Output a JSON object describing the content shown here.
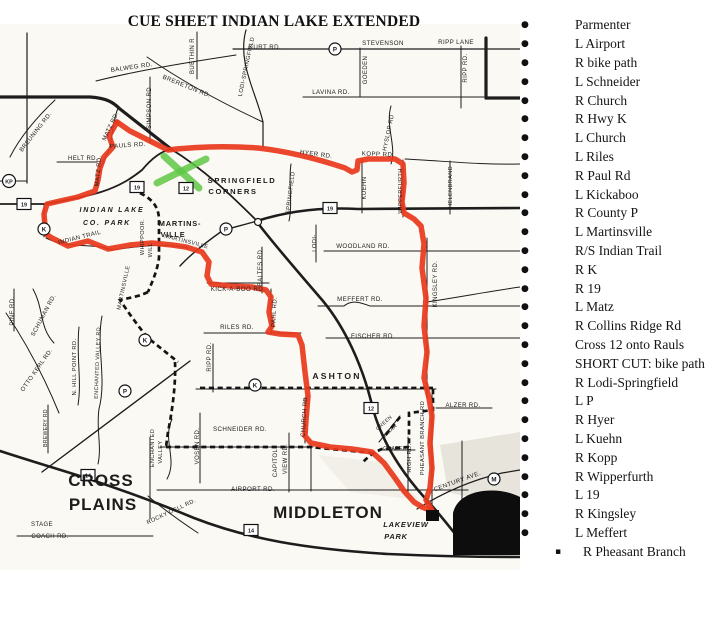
{
  "title": "CUE SHEET INDIAN LAKE EXTENDED",
  "cues": {
    "items": [
      {
        "bullet": "round",
        "text": "Parmenter"
      },
      {
        "bullet": "round",
        "text": "L Airport"
      },
      {
        "bullet": "round",
        "text": "R bike path"
      },
      {
        "bullet": "round",
        "text": "L Schneider"
      },
      {
        "bullet": "round",
        "text": "R Church"
      },
      {
        "bullet": "round",
        "text": "R Hwy K"
      },
      {
        "bullet": "round",
        "text": "L Church"
      },
      {
        "bullet": "round",
        "text": "L Riles"
      },
      {
        "bullet": "round",
        "text": "R Paul Rd"
      },
      {
        "bullet": "round",
        "text": "L Kickaboo"
      },
      {
        "bullet": "round",
        "text": "R County P"
      },
      {
        "bullet": "round",
        "text": "L Martinsville"
      },
      {
        "bullet": "round",
        "text": "R/S Indian Trail"
      },
      {
        "bullet": "round",
        "text": "R K"
      },
      {
        "bullet": "round",
        "text": "R 19"
      },
      {
        "bullet": "round",
        "text": "L Matz"
      },
      {
        "bullet": "round",
        "text": "R Collins Ridge Rd"
      },
      {
        "bullet": "round",
        "text": "Cross 12 onto Rauls"
      },
      {
        "bullet": "round",
        "text": "SHORT CUT: bike path"
      },
      {
        "bullet": "round",
        "text": "R Lodi-Springfield"
      },
      {
        "bullet": "round",
        "text": "L P"
      },
      {
        "bullet": "round",
        "text": "R Hyer"
      },
      {
        "bullet": "round",
        "text": "L Kuehn"
      },
      {
        "bullet": "round",
        "text": "R Kopp"
      },
      {
        "bullet": "round",
        "text": "R Wipperfurth"
      },
      {
        "bullet": "round",
        "text": "L 19"
      },
      {
        "bullet": "round",
        "text": "R Kingsley"
      },
      {
        "bullet": "round",
        "text": "L Meffert"
      },
      {
        "bullet": "square",
        "text": "R Pheasant Branch"
      }
    ]
  },
  "map": {
    "colors": {
      "route": "#e8391d",
      "shortcut": "#141414",
      "highlight": "#5ec844",
      "lake": "#0d0d0d",
      "shade": "#d8d4ca",
      "paper": "#fbf9f3"
    },
    "labels": [
      {
        "t": "KURT RD.",
        "x": 265,
        "y": 49,
        "r": 0,
        "s": 6.2
      },
      {
        "t": "STEVENSON",
        "x": 383,
        "y": 45,
        "r": 0,
        "s": 6.2
      },
      {
        "t": "RIPP LANE",
        "x": 456,
        "y": 44,
        "r": 0,
        "s": 6.2
      },
      {
        "t": "BALWEG RD.",
        "x": 132,
        "y": 69,
        "r": -8,
        "s": 6.2
      },
      {
        "t": "BUETHIN R",
        "x": 194,
        "y": 56,
        "r": -90,
        "s": 6
      },
      {
        "t": "BRERETON RD.",
        "x": 186,
        "y": 88,
        "r": 22,
        "s": 6.2
      },
      {
        "t": "LODI-SPRINGFIELD",
        "x": 248,
        "y": 67,
        "r": -78,
        "s": 5.8
      },
      {
        "t": "GOEDEN",
        "x": 367,
        "y": 70,
        "r": -90,
        "s": 6
      },
      {
        "t": "LAVINA RD.",
        "x": 331,
        "y": 94,
        "r": 0,
        "s": 6.2
      },
      {
        "t": "RIPP RD.",
        "x": 467,
        "y": 68,
        "r": -90,
        "s": 6
      },
      {
        "t": "HYSLOP RD",
        "x": 390,
        "y": 133,
        "r": -78,
        "s": 5.8
      },
      {
        "t": "SIMPSON RD",
        "x": 151,
        "y": 108,
        "r": -90,
        "s": 6
      },
      {
        "t": "MATZ RD.",
        "x": 112,
        "y": 127,
        "r": -65,
        "s": 6
      },
      {
        "t": "MATZ RD.",
        "x": 100,
        "y": 171,
        "r": -85,
        "s": 6
      },
      {
        "t": "HELT RD.",
        "x": 83,
        "y": 160,
        "r": 0,
        "s": 6
      },
      {
        "t": "BREUNING RD.",
        "x": 37,
        "y": 133,
        "r": -52,
        "s": 6
      },
      {
        "t": "PAULS RD.",
        "x": 128,
        "y": 147,
        "r": -4,
        "s": 6.2
      },
      {
        "t": "HYER RD.",
        "x": 316,
        "y": 156,
        "r": 8,
        "s": 6.2
      },
      {
        "t": "KOPP RD.",
        "x": 378,
        "y": 156,
        "r": 2,
        "s": 6.2
      },
      {
        "t": "KUEHN",
        "x": 366,
        "y": 188,
        "r": -90,
        "s": 6
      },
      {
        "t": "WIPPERFURTH",
        "x": 402,
        "y": 191,
        "r": -90,
        "s": 5.6
      },
      {
        "t": "HELENBRAND",
        "x": 452,
        "y": 187,
        "r": -90,
        "s": 5.6
      },
      {
        "t": "SPRINGFIELD",
        "x": 292,
        "y": 193,
        "r": -83,
        "s": 5.8
      },
      {
        "t": "LODI-",
        "x": 316,
        "y": 243,
        "r": -90,
        "s": 5.8
      },
      {
        "t": "WOODLAND RD.",
        "x": 363,
        "y": 248,
        "r": 0,
        "s": 6.2
      },
      {
        "t": "MEFFERT RD.",
        "x": 360,
        "y": 301,
        "r": 0,
        "s": 6.2
      },
      {
        "t": "FISCHER RD.",
        "x": 373,
        "y": 338,
        "r": 0,
        "s": 6.2
      },
      {
        "t": "KINGSLEY RD.",
        "x": 437,
        "y": 284,
        "r": -90,
        "s": 6
      },
      {
        "t": "MARTINSVILLE",
        "x": 186,
        "y": 243,
        "r": 14,
        "s": 5.6
      },
      {
        "t": "WHIPPOOR.",
        "x": 144,
        "y": 237,
        "r": -90,
        "s": 5.6
      },
      {
        "t": "WILL",
        "x": 152,
        "y": 250,
        "r": -90,
        "s": 5.6
      },
      {
        "t": "MARTINSVILLE",
        "x": 125,
        "y": 288,
        "r": -78,
        "s": 5.6
      },
      {
        "t": "INDIAN TRAIL",
        "x": 80,
        "y": 239,
        "r": -14,
        "s": 6
      },
      {
        "t": "KICK-A-BOO RD.",
        "x": 238,
        "y": 291,
        "r": 0,
        "s": 6.2
      },
      {
        "t": "PAHL RD.",
        "x": 276,
        "y": 312,
        "r": -87,
        "s": 6
      },
      {
        "t": "BALTES RD.",
        "x": 262,
        "y": 267,
        "r": -90,
        "s": 6
      },
      {
        "t": "RILES RD.",
        "x": 237,
        "y": 329,
        "r": 0,
        "s": 6.2
      },
      {
        "t": "RIPP RD.",
        "x": 211,
        "y": 357,
        "r": -90,
        "s": 6
      },
      {
        "t": "SCHNEIDER RD.",
        "x": 240,
        "y": 431,
        "r": 0,
        "s": 6.2
      },
      {
        "t": "VOSEN RD.",
        "x": 199,
        "y": 446,
        "r": -90,
        "s": 6
      },
      {
        "t": "CAPITOL",
        "x": 277,
        "y": 463,
        "r": -90,
        "s": 6
      },
      {
        "t": "VIEW RD.",
        "x": 287,
        "y": 459,
        "r": -90,
        "s": 6
      },
      {
        "t": "CHURCH RD.",
        "x": 306,
        "y": 416,
        "r": -86,
        "s": 6
      },
      {
        "t": "ENCHANTED VALLEY RD.",
        "x": 99,
        "y": 362,
        "r": -88,
        "s": 5.4
      },
      {
        "t": "ENCHANTED",
        "x": 154,
        "y": 448,
        "r": -90,
        "s": 5.6
      },
      {
        "t": "VALLEY",
        "x": 162,
        "y": 452,
        "r": -90,
        "s": 5.6
      },
      {
        "t": "N. HILL POINT RD.",
        "x": 76,
        "y": 367,
        "r": -90,
        "s": 5.8
      },
      {
        "t": "OTTO KERL RD.",
        "x": 38,
        "y": 371,
        "r": -55,
        "s": 6
      },
      {
        "t": "SCHUMAN RD.",
        "x": 45,
        "y": 316,
        "r": -62,
        "s": 6
      },
      {
        "t": "PINE RD.",
        "x": 14,
        "y": 311,
        "r": -90,
        "s": 6
      },
      {
        "t": "BREWERY RD",
        "x": 47,
        "y": 428,
        "r": -90,
        "s": 5
      },
      {
        "t": "ROCKY DELL RD.",
        "x": 172,
        "y": 513,
        "r": -25,
        "s": 5.8
      },
      {
        "t": "AIRPORT RD.",
        "x": 253,
        "y": 491,
        "r": 0,
        "s": 6.2
      },
      {
        "t": "STAGE",
        "x": 42,
        "y": 526,
        "r": 0,
        "s": 6
      },
      {
        "t": "COACH RD.",
        "x": 50,
        "y": 538,
        "r": 0,
        "s": 6
      },
      {
        "t": "CENTURY AVE.",
        "x": 458,
        "y": 483,
        "r": -20,
        "s": 6.2
      },
      {
        "t": "ALZER RD.",
        "x": 463,
        "y": 407,
        "r": 0,
        "s": 6
      },
      {
        "t": "GREEN",
        "x": 385,
        "y": 424,
        "r": -42,
        "s": 5
      },
      {
        "t": "BRIAR",
        "x": 391,
        "y": 432,
        "r": -42,
        "s": 5
      },
      {
        "t": "GRABER",
        "x": 395,
        "y": 450,
        "r": 0,
        "s": 5
      },
      {
        "t": "HIGH RD.",
        "x": 411,
        "y": 458,
        "r": -90,
        "s": 5.8
      },
      {
        "t": "PHEASANT BRANCH RD",
        "x": 424,
        "y": 438,
        "r": -90,
        "s": 5.8
      },
      {
        "t": "SPRINGFIELD",
        "x": 242,
        "y": 183,
        "r": 0,
        "s": 7.6,
        "b": 1,
        "ls": 1.6,
        "k": "town-label"
      },
      {
        "t": "CORNERS",
        "x": 233,
        "y": 194,
        "r": 0,
        "s": 7.6,
        "b": 1,
        "ls": 1.6,
        "k": "town-label"
      },
      {
        "t": "MARTINS-",
        "x": 180,
        "y": 226,
        "r": 0,
        "s": 7.4,
        "b": 1,
        "ls": 0.8,
        "k": "town-label"
      },
      {
        "t": "VILLE",
        "x": 173,
        "y": 237,
        "r": 0,
        "s": 7.4,
        "b": 1,
        "ls": 0.8,
        "k": "town-label"
      },
      {
        "t": "INDIAN LAKE",
        "x": 112,
        "y": 212,
        "r": 0,
        "s": 7,
        "b": 1,
        "i": 1,
        "ls": 1.8,
        "k": "town-label"
      },
      {
        "t": "CO. PARK",
        "x": 107,
        "y": 225,
        "r": 0,
        "s": 7,
        "b": 1,
        "i": 1,
        "ls": 1.8,
        "k": "town-label"
      },
      {
        "t": "ASHTON",
        "x": 337,
        "y": 379,
        "r": 0,
        "s": 8.6,
        "b": 1,
        "ls": 2.2,
        "k": "town-label"
      },
      {
        "t": "CROSS",
        "x": 101,
        "y": 486,
        "r": 0,
        "s": 17,
        "b": 1,
        "ls": 1,
        "k": "town-label"
      },
      {
        "t": "PLAINS",
        "x": 103,
        "y": 510,
        "r": 0,
        "s": 17,
        "b": 1,
        "ls": 1,
        "k": "town-label"
      },
      {
        "t": "MIDDLETON",
        "x": 328,
        "y": 518,
        "r": 0,
        "s": 17,
        "b": 1,
        "ls": 1,
        "k": "town-label"
      },
      {
        "t": "LAKEVIEW",
        "x": 406,
        "y": 527,
        "r": 0,
        "s": 7.4,
        "b": 1,
        "i": 1,
        "ls": 0.8,
        "k": "town-label"
      },
      {
        "t": "PARK",
        "x": 396,
        "y": 539,
        "r": 0,
        "s": 7.4,
        "b": 1,
        "i": 1,
        "ls": 0.8,
        "k": "town-label"
      }
    ],
    "shields": [
      {
        "shape": "circle",
        "label": "KP",
        "x": 9,
        "y": 181
      },
      {
        "shape": "circle",
        "label": "K",
        "x": 44,
        "y": 229
      },
      {
        "shape": "circle",
        "label": "K",
        "x": 145,
        "y": 340
      },
      {
        "shape": "circle",
        "label": "K",
        "x": 255,
        "y": 385
      },
      {
        "shape": "circle",
        "label": "P",
        "x": 335,
        "y": 49
      },
      {
        "shape": "circle",
        "label": "P",
        "x": 226,
        "y": 229
      },
      {
        "shape": "circle",
        "label": "P",
        "x": 125,
        "y": 391
      },
      {
        "shape": "circle",
        "label": "M",
        "x": 494,
        "y": 479
      },
      {
        "shape": "box",
        "label": "19",
        "x": 24,
        "y": 204
      },
      {
        "shape": "box",
        "label": "19",
        "x": 137,
        "y": 187
      },
      {
        "shape": "box",
        "label": "19",
        "x": 330,
        "y": 208
      },
      {
        "shape": "box",
        "label": "12",
        "x": 186,
        "y": 188
      },
      {
        "shape": "box",
        "label": "12",
        "x": 371,
        "y": 408
      },
      {
        "shape": "box",
        "label": "14",
        "x": 88,
        "y": 475
      },
      {
        "shape": "box",
        "label": "14",
        "x": 251,
        "y": 530
      }
    ]
  }
}
